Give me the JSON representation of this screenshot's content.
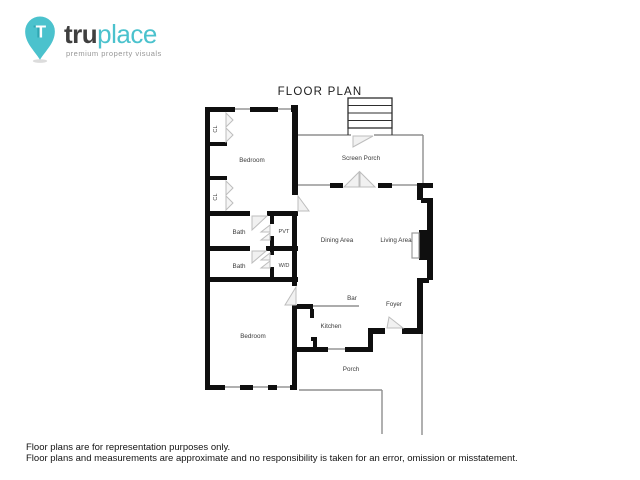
{
  "logo": {
    "brand_bold": "tru",
    "brand_light": "place",
    "tagline": "premium property visuals",
    "pin_letter": "T"
  },
  "title": "FLOOR PLAN",
  "rooms": {
    "closet_top": {
      "label": "CL"
    },
    "closet_bottom": {
      "label": "CL"
    },
    "bedroom_top": {
      "label": "Bedroom"
    },
    "screen_porch": {
      "label": "Screen Porch"
    },
    "bath_top": {
      "label": "Bath"
    },
    "pvt": {
      "label": "PVT"
    },
    "bath_bottom": {
      "label": "Bath"
    },
    "washer_dryer": {
      "label": "W/D"
    },
    "dining": {
      "label": "Dining Area"
    },
    "living": {
      "label": "Living Area"
    },
    "bar": {
      "label": "Bar"
    },
    "foyer": {
      "label": "Foyer"
    },
    "kitchen": {
      "label": "Kitchen"
    },
    "bedroom_bottom": {
      "label": "Bedroom"
    },
    "porch": {
      "label": "Porch"
    }
  },
  "colors": {
    "accent_teal": "#4bc2cd",
    "wall_black": "#0f0f0f",
    "thin_gray": "#8f8f8f",
    "door_gray": "#bdbdbd",
    "label_gray": "#3a3a3a"
  },
  "footer": {
    "line1": "Floor plans are for representation purposes only.",
    "line2": "Floor plans and measurements are approximate and no responsibility is taken for an error, omission or misstatement."
  }
}
